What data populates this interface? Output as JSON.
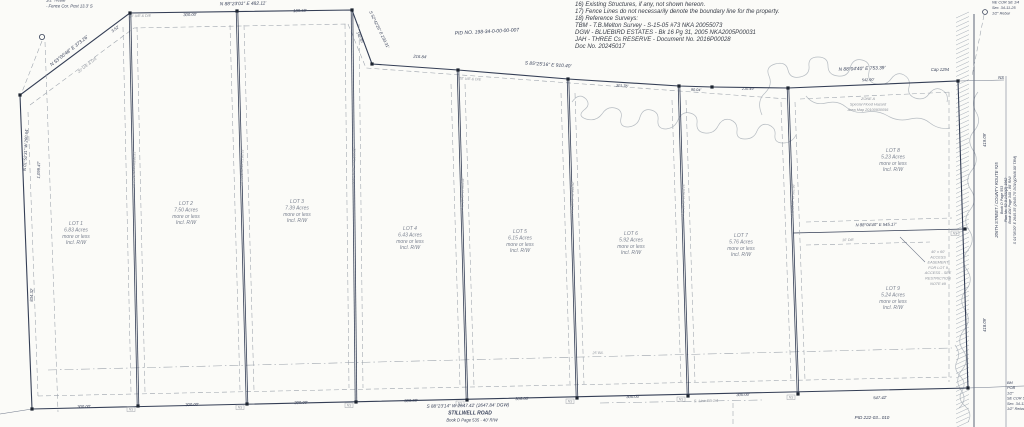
{
  "plat": {
    "pid_top": "PID NO. 198-34-0-00-00-007",
    "pid_bottom": "PID 222-03...010",
    "ns_tag": "NS",
    "notes": [
      "16) Existing Structures, if any, not shown hereon.",
      "17) Fence Lines do not necessarily denote the boundary line for the property.",
      "18) Reference Surveys:",
      "      TBM - T.B.Melton Survey - S-15-05 #73 NKA 20055073",
      "      DGW - BLUEBIRD ESTATES - Bk 16 Pg 31, 2005 NKA2005P00031",
      "      JAH - THREE Cs RESERVE - Document No. 2016P00028",
      "            Doc No. 20245017"
    ],
    "top_left_corner": [
      "1/2\" Rebar",
      "- Fence Cor. Post 13.3' S"
    ],
    "top_right_corner": [
      "NE COR SE 1/4",
      "Sec. 34-11-25",
      "1/2\" Rebar"
    ],
    "bottom_right_corner": [
      "BM",
      "POB",
      "1/2\"",
      "SE COR SE",
      "Sec. 34-11",
      "1/2\" Rebar"
    ],
    "road_bottom": {
      "bearing": "S 88°23'14\" W  2647.42' (2647.84' DGW)",
      "name": "STILLWELL ROAD",
      "book": "Book D Page 535 - 40' R/W"
    },
    "road_right": [
      "206TH STREET / COUNTY ROUTE #25",
      "Book D Page 553",
      "Plan No. 52-0-1431(2) 1962",
      "Book 404 Page 340 - 80' R/W",
      "S 01°05'20\" E  2645.35' (2645.75' DGW)(2646.00' TBM)"
    ],
    "flood_zone": [
      "ZONE A",
      "Special Flood Hazard",
      "Area Map 20100930056"
    ],
    "access_note": [
      "40' x 60'",
      "ACCESS",
      "EASEMENT",
      "FOR LOT 9",
      "ACCESS - SEE",
      "RESTRICTION",
      "NOTE #9"
    ],
    "more_less": "more or less",
    "incl": "Incl. R/W",
    "lots": [
      {
        "name": "LOT 1",
        "acres": "6.83 Acres",
        "x": 76,
        "y": 225
      },
      {
        "name": "LOT 2",
        "acres": "7.50 Acres",
        "x": 186,
        "y": 205
      },
      {
        "name": "LOT 3",
        "acres": "7.39 Acres",
        "x": 297,
        "y": 203
      },
      {
        "name": "LOT 4",
        "acres": "6.43 Acres",
        "x": 410,
        "y": 230
      },
      {
        "name": "LOT 5",
        "acres": "6.15 Acres",
        "x": 520,
        "y": 233
      },
      {
        "name": "LOT 6",
        "acres": "5.92 Acres",
        "x": 631,
        "y": 235
      },
      {
        "name": "LOT 7",
        "acres": "5.76 Acres",
        "x": 741,
        "y": 237
      },
      {
        "name": "LOT 8",
        "acres": "5.23 Acres",
        "x": 893,
        "y": 152
      },
      {
        "name": "LOT 9",
        "acres": "5.24 Acres",
        "x": 893,
        "y": 290
      }
    ],
    "dividers": [
      {
        "x1": 130,
        "y1": 13,
        "x2": 138,
        "y2": 406,
        "label": "N 01°36'46\" W  1,161.21'"
      },
      {
        "x1": 237,
        "y1": 11,
        "x2": 247,
        "y2": 404,
        "label": "N 01°36'46\" W  1,168.53'"
      },
      {
        "x1": 352,
        "y1": 10,
        "x2": 356,
        "y2": 402,
        "label": "N 01°36'46\" W  1,158.02'"
      },
      {
        "x1": 458,
        "y1": 70,
        "x2": 467,
        "y2": 400,
        "label": "N 01°36'46\" W  983.04'"
      },
      {
        "x1": 568,
        "y1": 79,
        "x2": 577,
        "y2": 398,
        "label": "N 01°36'46\" W  946.92'"
      },
      {
        "x1": 679,
        "y1": 86,
        "x2": 688,
        "y2": 396,
        "label": "N 01°36'46\" W  913.75'"
      },
      {
        "x1": 788,
        "y1": 88,
        "x2": 798,
        "y2": 394,
        "label": "N 01°36'46\" W  902.66'"
      }
    ],
    "labels": [
      {
        "t": "PID NO. 198-34-0-00-00-007",
        "x": 487,
        "y": 33,
        "r": -3,
        "s": 5,
        "c": "d",
        "n": "pid-top-label"
      },
      {
        "t": "N 53°00'48\" E  373.26'",
        "x": 70,
        "y": 52,
        "r": -38,
        "s": 4.8,
        "c": "d",
        "n": "bearing-nw-diagonal"
      },
      {
        "t": "20' U/E & D/E",
        "x": 88,
        "y": 66,
        "r": -38,
        "s": 3.8,
        "c": "g",
        "n": "easement-label"
      },
      {
        "t": "3.52'",
        "x": 116,
        "y": 30,
        "r": -38,
        "s": 4,
        "c": "d",
        "n": "distance-label"
      },
      {
        "t": "1,099.47'",
        "x": 40,
        "y": 170,
        "r": -88,
        "s": 4.2,
        "c": "d",
        "n": "distance-label"
      },
      {
        "t": "N 01°52'31\" W  260.64'",
        "x": 27,
        "y": 150,
        "r": -87,
        "s": 4.2,
        "c": "d",
        "n": "bearing-west-line"
      },
      {
        "t": "834.32'",
        "x": 33,
        "y": 295,
        "r": -88,
        "s": 4.2,
        "c": "d",
        "n": "distance-label"
      },
      {
        "t": "N 88°23'01\" E  482.11'",
        "x": 243,
        "y": 5,
        "r": -1,
        "s": 4.8,
        "c": "d",
        "n": "bearing-north-line"
      },
      {
        "t": "300.00'",
        "x": 190,
        "y": 16,
        "r": -1,
        "s": 4.2,
        "c": "d",
        "n": "distance-label"
      },
      {
        "t": "20' U/E & D/E",
        "x": 140,
        "y": 17,
        "r": -1,
        "s": 3.6,
        "c": "g",
        "n": "easement-label"
      },
      {
        "t": "189.59'",
        "x": 300,
        "y": 12,
        "r": -1,
        "s": 4.2,
        "c": "d",
        "n": "distance-label"
      },
      {
        "t": "S 52°42'26\" E  230.31'",
        "x": 378,
        "y": 30,
        "r": 64,
        "s": 4.2,
        "c": "d",
        "n": "bearing-ne-diagonal"
      },
      {
        "t": "142.85'",
        "x": 359,
        "y": 38,
        "r": 64,
        "s": 3.8,
        "c": "d",
        "n": "distance-label"
      },
      {
        "t": "216.84'",
        "x": 420,
        "y": 58,
        "r": 3,
        "s": 4.2,
        "c": "d",
        "n": "distance-label"
      },
      {
        "t": "20' U/E & D/E",
        "x": 470,
        "y": 80,
        "r": 3,
        "s": 3.6,
        "c": "g",
        "n": "easement-label"
      },
      {
        "t": "S 85°25'16\" E  910.40'",
        "x": 548,
        "y": 66,
        "r": 4,
        "s": 4.8,
        "c": "d",
        "n": "bearing-north-line"
      },
      {
        "t": "301.76'",
        "x": 622,
        "y": 87,
        "r": 4,
        "s": 3.8,
        "c": "d",
        "n": "distance-label"
      },
      {
        "t": "90.04'",
        "x": 696,
        "y": 91,
        "r": 2,
        "s": 3.8,
        "c": "d",
        "n": "distance-label"
      },
      {
        "t": "210.49'",
        "x": 748,
        "y": 90,
        "r": 1,
        "s": 3.8,
        "c": "d",
        "n": "distance-label"
      },
      {
        "t": "N 88°04'40\" E  753.39'",
        "x": 862,
        "y": 70,
        "r": -2,
        "s": 4.8,
        "c": "d",
        "n": "bearing-north-line"
      },
      {
        "t": "542.90'",
        "x": 868,
        "y": 81,
        "r": -2,
        "s": 3.8,
        "c": "d",
        "n": "distance-label"
      },
      {
        "t": "Cap 1294",
        "x": 940,
        "y": 71,
        "r": 0,
        "s": 4.2,
        "c": "d",
        "n": "monument-label"
      },
      {
        "t": "NS",
        "x": 1001,
        "y": 79,
        "r": 0,
        "s": 4.2,
        "c": "d",
        "n": "monument-label"
      },
      {
        "t": "N 88°04'40\" E  545.17'",
        "x": 876,
        "y": 226,
        "r": -1,
        "s": 4.2,
        "c": "d",
        "n": "bearing-lot8-9-line"
      },
      {
        "t": "10' D/E",
        "x": 848,
        "y": 241,
        "r": -1,
        "s": 3.6,
        "c": "g",
        "n": "easement-label"
      },
      {
        "t": "419.09'",
        "x": 986,
        "y": 140,
        "r": -90,
        "s": 4.2,
        "c": "d",
        "n": "distance-label"
      },
      {
        "t": "418.09'",
        "x": 986,
        "y": 325,
        "r": -90,
        "s": 4.2,
        "c": "d",
        "n": "distance-label"
      },
      {
        "t": "547.42'",
        "x": 880,
        "y": 399,
        "r": -1,
        "s": 4.2,
        "c": "d",
        "n": "distance-label"
      },
      {
        "t": "300.00'",
        "x": 84,
        "y": 408,
        "r": -1,
        "s": 4.2,
        "c": "d",
        "n": "distance-label"
      },
      {
        "t": "300.00'",
        "x": 192,
        "y": 406,
        "r": -1,
        "s": 4.2,
        "c": "d",
        "n": "distance-label"
      },
      {
        "t": "300.00'",
        "x": 301,
        "y": 404,
        "r": -1,
        "s": 4.2,
        "c": "d",
        "n": "distance-label"
      },
      {
        "t": "300.00'",
        "x": 411,
        "y": 402,
        "r": -1,
        "s": 4.2,
        "c": "d",
        "n": "distance-label"
      },
      {
        "t": "300.00'",
        "x": 522,
        "y": 400,
        "r": -1,
        "s": 4.2,
        "c": "d",
        "n": "distance-label"
      },
      {
        "t": "300.00'",
        "x": 633,
        "y": 398,
        "r": -1,
        "s": 4.2,
        "c": "d",
        "n": "distance-label"
      },
      {
        "t": "300.00'",
        "x": 743,
        "y": 396,
        "r": -1,
        "s": 4.2,
        "c": "d",
        "n": "distance-label"
      },
      {
        "t": "25' B/L",
        "x": 598,
        "y": 354,
        "r": -1,
        "s": 3.6,
        "c": "g",
        "n": "building-line-label"
      },
      {
        "t": "S. Line SE 1/4",
        "x": 706,
        "y": 402,
        "r": -1,
        "s": 3.8,
        "c": "g",
        "n": "section-line-label"
      },
      {
        "t": "PID 222-03...010",
        "x": 872,
        "y": 419,
        "r": 0,
        "s": 4.6,
        "c": "d",
        "n": "pid-bottom-label"
      }
    ]
  }
}
